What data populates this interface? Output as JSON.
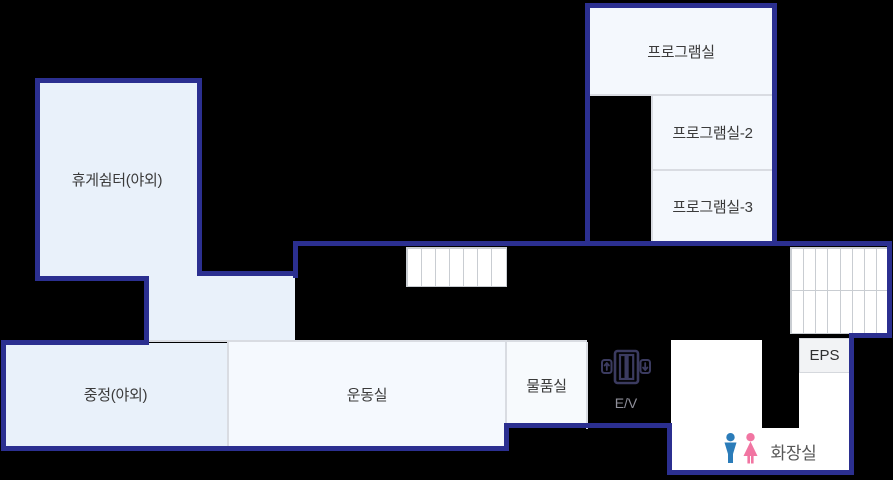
{
  "page": {
    "background_color": "#000000",
    "wall_color": "#2b2f90",
    "divider_color": "#d9dce2"
  },
  "rooms": {
    "program_room": {
      "label": "프로그램실",
      "fill": "#f4f8fd"
    },
    "program_room_2": {
      "label": "프로그램실-2",
      "fill": "#f4f8fd"
    },
    "program_room_3": {
      "label": "프로그램실-3",
      "fill": "#f4f8fd"
    },
    "rest_shelter": {
      "label": "휴게쉼터(야외)",
      "fill": "#e9f1fa"
    },
    "courtyard": {
      "label": "중정(야외)",
      "fill": "#e9f1fa"
    },
    "exercise_room": {
      "label": "운동실",
      "fill": "#f5f9fe"
    },
    "storage_room": {
      "label": "물품실",
      "fill": "#f7fafd"
    },
    "restroom": {
      "label": "화장실",
      "fill": "#ffffff"
    },
    "eps": {
      "label": "EPS",
      "fill": "#f2f3f5"
    }
  },
  "elevator": {
    "label": "E/V",
    "icon": "elevator-icon",
    "icon_color": "#3b3b60",
    "label_color": "#8f8f9a"
  },
  "restroom_icons": {
    "male_icon": "male-icon",
    "male_color": "#2b7cb9",
    "female_icon": "female-icon",
    "female_color": "#f175a2"
  },
  "stairs": {
    "middle": {
      "steps": 7,
      "rows": 1
    },
    "right": {
      "steps": 8,
      "rows": 2
    }
  }
}
